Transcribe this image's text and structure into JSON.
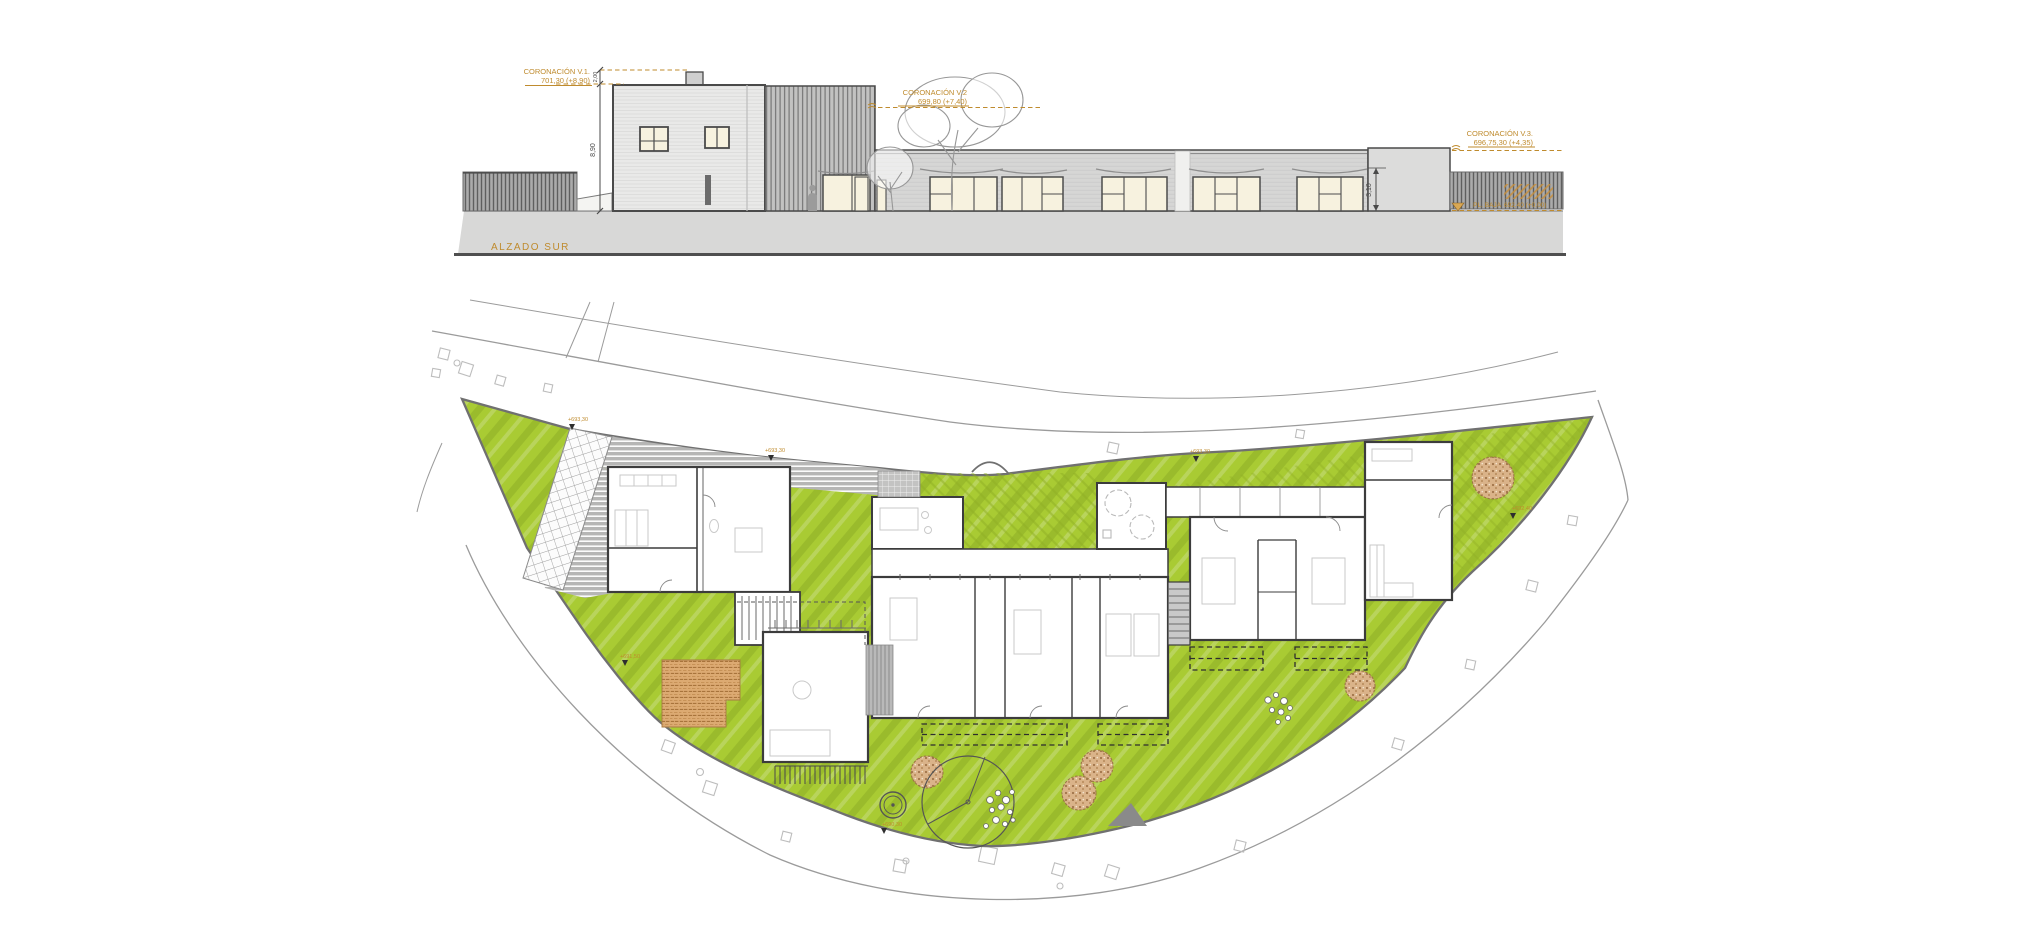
{
  "sheet": {
    "background": "#ffffff"
  },
  "colors": {
    "annotation_orange": "#bf8b2e",
    "grass_green": "#a9cb33",
    "wall_dark": "#3f3f3f",
    "ground_gray": "#d8d8d7",
    "deck_orange": "#dcaa72",
    "gravel_brown": "#d8b08a"
  },
  "elevation": {
    "title": "ALZADO SUR",
    "levels": [
      {
        "name": "CORONACIÓN V.1.",
        "elevation": "701,30 (+8,90)"
      },
      {
        "name": "CORONACIÓN V.2",
        "elevation": "699,80 (+7,40)"
      },
      {
        "name": "CORONACIÓN V.3.",
        "elevation": "696,75,30 (+4,35)"
      },
      {
        "name": "PL. BAJA",
        "elevation": "692,40 (+0,00)"
      }
    ],
    "dimensions": [
      {
        "value": "2,00"
      },
      {
        "value": "8,90"
      },
      {
        "value": "3,10"
      }
    ]
  },
  "plan": {
    "spot_elevations": [
      {
        "value": "+693,30"
      },
      {
        "value": "+693,30"
      },
      {
        "value": "+693,30"
      },
      {
        "value": "+692,40"
      },
      {
        "value": "+691,50"
      },
      {
        "value": "+690,30"
      }
    ]
  }
}
